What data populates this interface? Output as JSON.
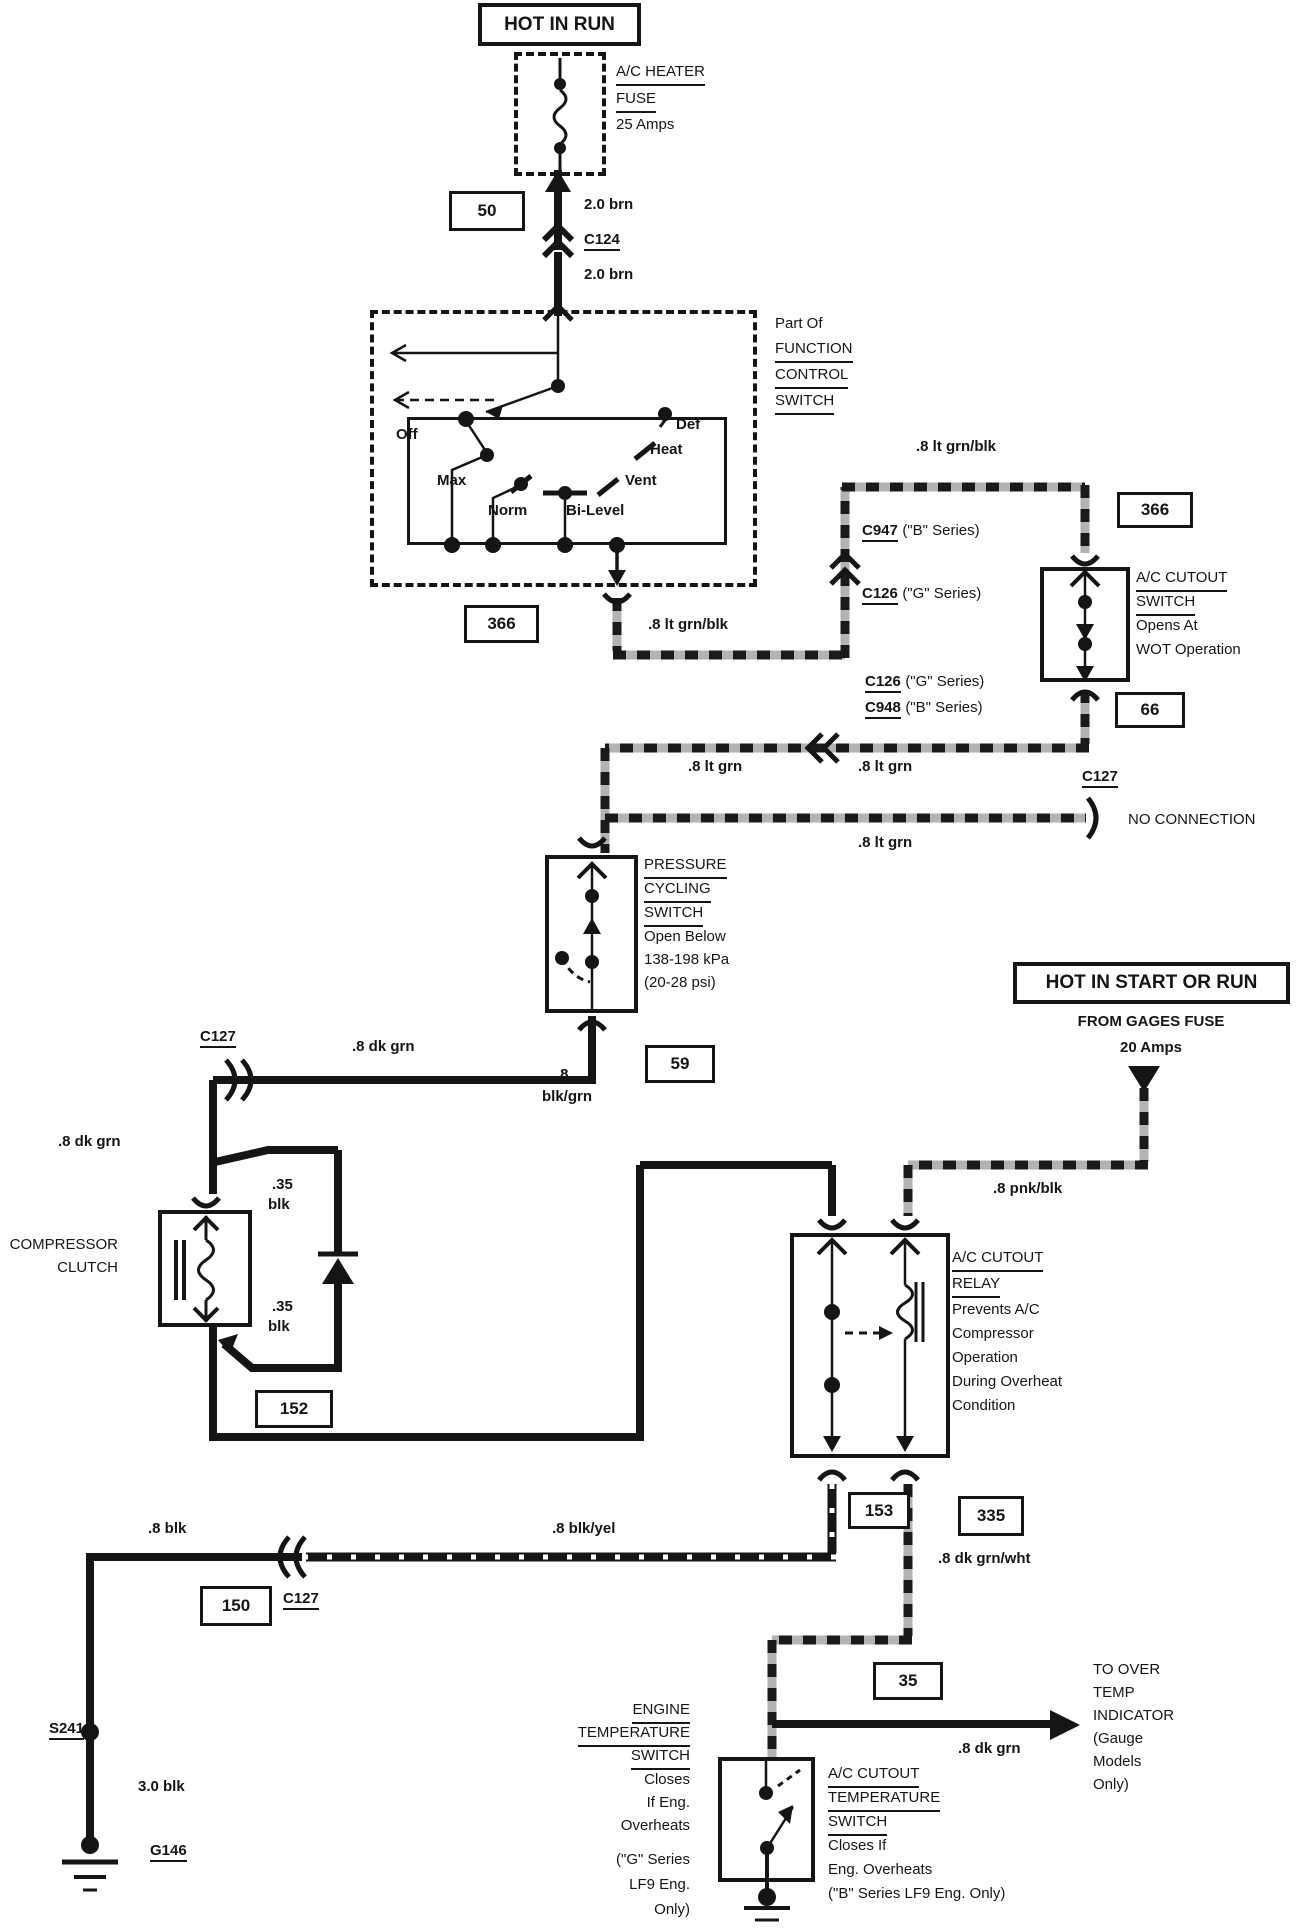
{
  "banners": {
    "hot_in_run": "HOT IN RUN",
    "hot_in_start_or_run": "HOT IN START OR RUN"
  },
  "fuse": {
    "line1": "A/C HEATER",
    "line2": "FUSE",
    "rating": "25 Amps"
  },
  "gages_fuse": {
    "from": "FROM GAGES FUSE",
    "rating": "20 Amps"
  },
  "circuit_boxes": {
    "c50": "50",
    "c366a": "366",
    "c366b": "366",
    "c66": "66",
    "c59": "59",
    "c152": "152",
    "c153": "153",
    "c335": "335",
    "c150": "150",
    "c35": "35"
  },
  "connectors": {
    "c124": "C124",
    "c947": {
      "ref": "C947",
      "suffix": "(\"B\" Series)"
    },
    "c126_upper": {
      "ref": "C126",
      "suffix": "(\"G\" Series)"
    },
    "c126_lower": {
      "ref": "C126",
      "suffix": "(\"G\" Series)"
    },
    "c948": {
      "ref": "C948",
      "suffix": "(\"B\" Series)"
    },
    "c127_noconn": {
      "ref": "C127",
      "note": "NO CONNECTION"
    },
    "c127_mid": "C127",
    "c127_low": "C127",
    "s241": "S241",
    "g146": "G146"
  },
  "wire_labels": {
    "brn_a": "2.0 brn",
    "brn_b": "2.0 brn",
    "ltgrnblk_a": ".8 lt grn/blk",
    "ltgrnblk_b": ".8 lt grn/blk",
    "ltgrn_a": ".8 lt grn",
    "ltgrn_b": ".8 lt grn",
    "ltgrn_c": ".8 lt grn",
    "dkgrn_a": ".8 dk grn",
    "dkgrn_b": ".8 dk grn",
    "dkgrn_c": ".8 dk grn",
    "pnkblk": ".8 pnk/blk",
    "blkgrn_l1": ".8",
    "blkgrn_l2": "blk/grn",
    "blk35_top_l1": ".35",
    "blk35_top_l2": "blk",
    "blk35_bot_l1": ".35",
    "blk35_bot_l2": "blk",
    "blkyel": ".8 blk/yel",
    "blk": ".8 blk",
    "blk30": "3.0 blk",
    "dkgrnwht": ".8 dk grn/wht"
  },
  "function_switch": {
    "caption": [
      "Part Of",
      "FUNCTION",
      "CONTROL",
      "SWITCH"
    ],
    "positions": [
      "Off",
      "Max",
      "Norm",
      "Bi-Level",
      "Vent",
      "Heat",
      "Def"
    ]
  },
  "wot_switch": {
    "name1": "A/C CUTOUT",
    "name2": "SWITCH",
    "desc1": "Opens At",
    "desc2": "WOT Operation"
  },
  "pressure_switch": {
    "name1": "PRESSURE",
    "name2": "CYCLING",
    "name3": "SWITCH",
    "desc1": "Open Below",
    "desc2": "138-198 kPa",
    "desc3": "(20-28 psi)"
  },
  "compressor_clutch": {
    "name1": "COMPRESSOR",
    "name2": "CLUTCH"
  },
  "relay": {
    "name1": "A/C CUTOUT",
    "name2": "RELAY",
    "desc": [
      "Prevents A/C",
      "Compressor",
      "Operation",
      "During Overheat",
      "Condition"
    ]
  },
  "engine_temp_switch": {
    "name1": "ENGINE",
    "name2": "TEMPERATURE",
    "name3": "SWITCH",
    "desc": [
      "Closes",
      "If Eng.",
      "Overheats"
    ],
    "note": [
      "(\"G\" Series",
      "LF9 Eng.",
      "Only)"
    ]
  },
  "ac_temp_switch": {
    "name1": "A/C CUTOUT",
    "name2": "TEMPERATURE",
    "name3": "SWITCH",
    "desc": [
      "Closes If",
      "Eng. Overheats",
      "(\"B\" Series LF9 Eng. Only)"
    ]
  },
  "over_temp": {
    "lines": [
      "TO OVER",
      "TEMP",
      "INDICATOR",
      "(Gauge",
      "Models",
      "Only)"
    ]
  }
}
